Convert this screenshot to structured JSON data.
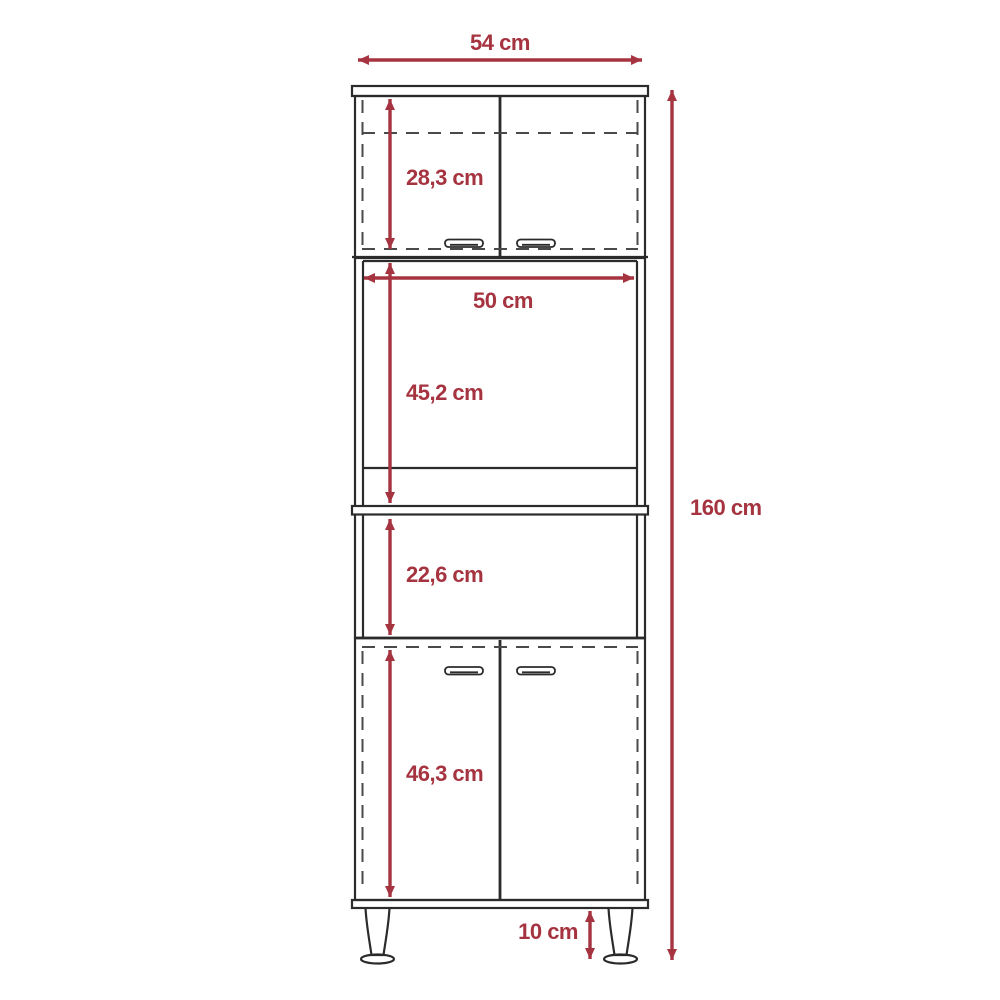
{
  "diagram": {
    "type": "furniture-dimension-diagram",
    "subject": "tall-pantry-cabinet-with-microwave-shelf",
    "unit": "cm",
    "colors": {
      "dimension_accent": "#A63440",
      "outline": "#2B2B2B",
      "dashed_line": "#4A4A4A",
      "background": "#FFFFFF"
    },
    "dimensions": [
      {
        "id": "overall-width",
        "label": "54 cm",
        "value": 54,
        "orientation": "horizontal"
      },
      {
        "id": "upper-cabinet-height",
        "label": "28,3 cm",
        "value": 28.3,
        "orientation": "vertical"
      },
      {
        "id": "inner-width",
        "label": "50 cm",
        "value": 50,
        "orientation": "horizontal"
      },
      {
        "id": "microwave-space-height",
        "label": "45,2 cm",
        "value": 45.2,
        "orientation": "vertical"
      },
      {
        "id": "overall-height",
        "label": "160 cm",
        "value": 160,
        "orientation": "vertical"
      },
      {
        "id": "open-shelf-height",
        "label": "22,6 cm",
        "value": 22.6,
        "orientation": "vertical"
      },
      {
        "id": "lower-cabinet-height",
        "label": "46,3 cm",
        "value": 46.3,
        "orientation": "vertical"
      },
      {
        "id": "leg-height",
        "label": "10 cm",
        "value": 10,
        "orientation": "vertical"
      }
    ]
  }
}
